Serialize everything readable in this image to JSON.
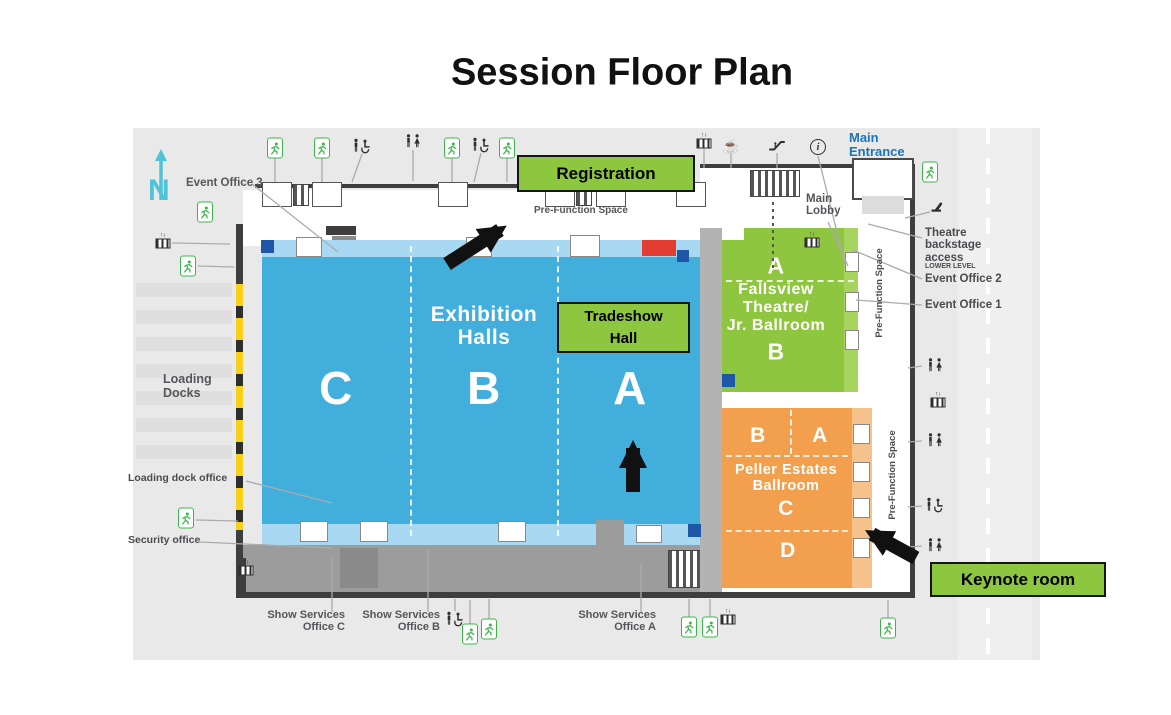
{
  "title": "Session Floor Plan",
  "compass": {
    "label": "N"
  },
  "halls": {
    "exhibition": {
      "name": "Exhibition\nHalls",
      "sections": {
        "c": "C",
        "b": "B",
        "a": "A"
      }
    },
    "fallsview": {
      "top": "A",
      "name": "Fallsview\nTheatre/\nJr. Ballroom",
      "bottom": "B"
    },
    "peller": {
      "top_left": "B",
      "top_right": "A",
      "name": "Peller Estates\nBallroom",
      "mid": "C",
      "bottom": "D"
    }
  },
  "callouts": {
    "registration": "Registration",
    "tradeshow": "Tradeshow\nHall",
    "keynote": "Keynote room"
  },
  "colors": {
    "hall_blue": "#41AEDB",
    "hall_blue_light": "#A9D9F2",
    "hall_green": "#8FC640",
    "hall_orange": "#F2A04E",
    "callout_green": "#8DC63F",
    "exit_green": "#3BB54A",
    "compass_cyan": "#4FC3D8",
    "entrance_blue": "#1B75BC",
    "alert_red": "#E23B30",
    "door_blue": "#1E56A8"
  },
  "labels": [
    {
      "id": "event-office-3",
      "text": "Event Office 3",
      "x": 186,
      "y": 177,
      "size": 11.5,
      "weight": 700,
      "color": "#55565A"
    },
    {
      "id": "pre-function-top",
      "text": "Pre-Function Space",
      "x": 534,
      "y": 206,
      "size": 10,
      "weight": 700,
      "color": "#55565A"
    },
    {
      "id": "main-lobby",
      "text": "Main\nLobby",
      "x": 806,
      "y": 193,
      "size": 11.5,
      "weight": 700,
      "color": "#55565A"
    },
    {
      "id": "main-entrance",
      "text": "Main\nEntrance",
      "x": 849,
      "y": 131,
      "size": 13,
      "weight": 700,
      "color": "#1B75BC"
    },
    {
      "id": "theatre-backstage",
      "text": "Theatre\nbackstage\naccess",
      "x": 925,
      "y": 227,
      "size": 11.5,
      "weight": 700,
      "color": "#4A4B4E"
    },
    {
      "id": "lower-level",
      "text": "LOWER LEVEL",
      "x": 925,
      "y": 263,
      "size": 7,
      "weight": 700,
      "color": "#4A4B4E"
    },
    {
      "id": "event-office-2",
      "text": "Event Office 2",
      "x": 925,
      "y": 273,
      "size": 11.5,
      "weight": 700,
      "color": "#4A4B4E"
    },
    {
      "id": "event-office-1",
      "text": "Event Office 1",
      "x": 925,
      "y": 299,
      "size": 11.5,
      "weight": 700,
      "color": "#4A4B4E"
    },
    {
      "id": "loading-docks",
      "text": "Loading\nDocks",
      "x": 163,
      "y": 373,
      "size": 12.5,
      "weight": 700,
      "color": "#55565A"
    },
    {
      "id": "loading-dock-office",
      "text": "Loading dock office",
      "x": 128,
      "y": 473,
      "size": 10.5,
      "weight": 700,
      "color": "#4A4B4E"
    },
    {
      "id": "security-office",
      "text": "Security office",
      "x": 128,
      "y": 535,
      "size": 10.5,
      "weight": 700,
      "color": "#4A4B4E"
    },
    {
      "id": "show-services-c",
      "text": "Show Services\nOffice C",
      "x": 345,
      "y": 610,
      "size": 11,
      "weight": 700,
      "color": "#55565A",
      "align": "right"
    },
    {
      "id": "show-services-b",
      "text": "Show Services\nOffice B",
      "x": 440,
      "y": 610,
      "size": 11,
      "weight": 700,
      "color": "#55565A",
      "align": "right"
    },
    {
      "id": "show-services-a",
      "text": "Show Services\nOffice A",
      "x": 656,
      "y": 610,
      "size": 11,
      "weight": 700,
      "color": "#55565A",
      "align": "right"
    },
    {
      "id": "pre-function-green",
      "text": "Pre-Function Space",
      "x": 880,
      "y": 293,
      "size": 9.5,
      "weight": 700,
      "color": "#4A4B4E",
      "rotate": -90
    },
    {
      "id": "pre-function-orange",
      "text": "Pre-Function Space",
      "x": 893,
      "y": 475,
      "size": 9.5,
      "weight": 700,
      "color": "#4A4B4E",
      "rotate": -90
    }
  ],
  "icons": [
    {
      "type": "exit",
      "x": 275,
      "y": 148
    },
    {
      "type": "exit",
      "x": 322,
      "y": 148
    },
    {
      "type": "accessible",
      "x": 362,
      "y": 146
    },
    {
      "type": "restroom",
      "x": 413,
      "y": 141
    },
    {
      "type": "exit",
      "x": 452,
      "y": 148
    },
    {
      "type": "accessible",
      "x": 481,
      "y": 145
    },
    {
      "type": "exit",
      "x": 507,
      "y": 148
    },
    {
      "type": "stairs",
      "x": 704,
      "y": 141
    },
    {
      "type": "coffee",
      "x": 731,
      "y": 146
    },
    {
      "type": "escalator",
      "x": 777,
      "y": 145
    },
    {
      "type": "info",
      "x": 818,
      "y": 147
    },
    {
      "type": "exit",
      "x": 930,
      "y": 172
    },
    {
      "type": "exit",
      "x": 205,
      "y": 212
    },
    {
      "type": "stairs",
      "x": 163,
      "y": 241
    },
    {
      "type": "exit",
      "x": 188,
      "y": 266
    },
    {
      "type": "exit",
      "x": 186,
      "y": 518
    },
    {
      "type": "stairs",
      "x": 246,
      "y": 568
    },
    {
      "type": "backstage",
      "x": 937,
      "y": 207
    },
    {
      "type": "stairs",
      "x": 812,
      "y": 240
    },
    {
      "type": "restroom",
      "x": 935,
      "y": 365
    },
    {
      "type": "stairs",
      "x": 938,
      "y": 400
    },
    {
      "type": "restroom",
      "x": 935,
      "y": 440
    },
    {
      "type": "accessible",
      "x": 935,
      "y": 505
    },
    {
      "type": "restroom",
      "x": 935,
      "y": 545
    },
    {
      "type": "accessible",
      "x": 455,
      "y": 619
    },
    {
      "type": "exit",
      "x": 470,
      "y": 634
    },
    {
      "type": "exit",
      "x": 489,
      "y": 629
    },
    {
      "type": "exit",
      "x": 689,
      "y": 627
    },
    {
      "type": "exit",
      "x": 710,
      "y": 627
    },
    {
      "type": "stairs",
      "x": 728,
      "y": 617
    },
    {
      "type": "exit",
      "x": 888,
      "y": 628
    }
  ]
}
